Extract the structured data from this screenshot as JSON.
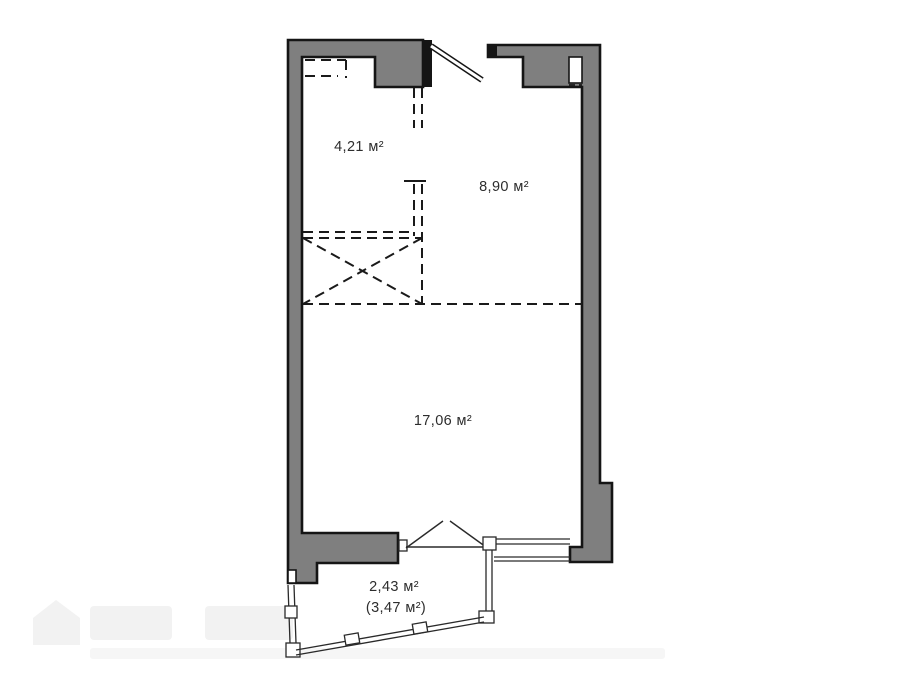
{
  "plan": {
    "title": "apartment-floor-plan",
    "rooms": [
      {
        "id": "hall",
        "area_label": "4,21 м²"
      },
      {
        "id": "kitchen",
        "area_label": "8,90 м²"
      },
      {
        "id": "living",
        "area_label": "17,06 м²"
      },
      {
        "id": "balcony",
        "area_label": "2,43 м²",
        "area_label_secondary": "(3,47 м²)"
      }
    ],
    "colors": {
      "wall_fill": "#7f7f7f",
      "wall_outline": "#151515",
      "line": "#1a1a1a",
      "label": "#2d2d2d",
      "background": "#ffffff",
      "watermark": "#f2f2f2"
    }
  }
}
